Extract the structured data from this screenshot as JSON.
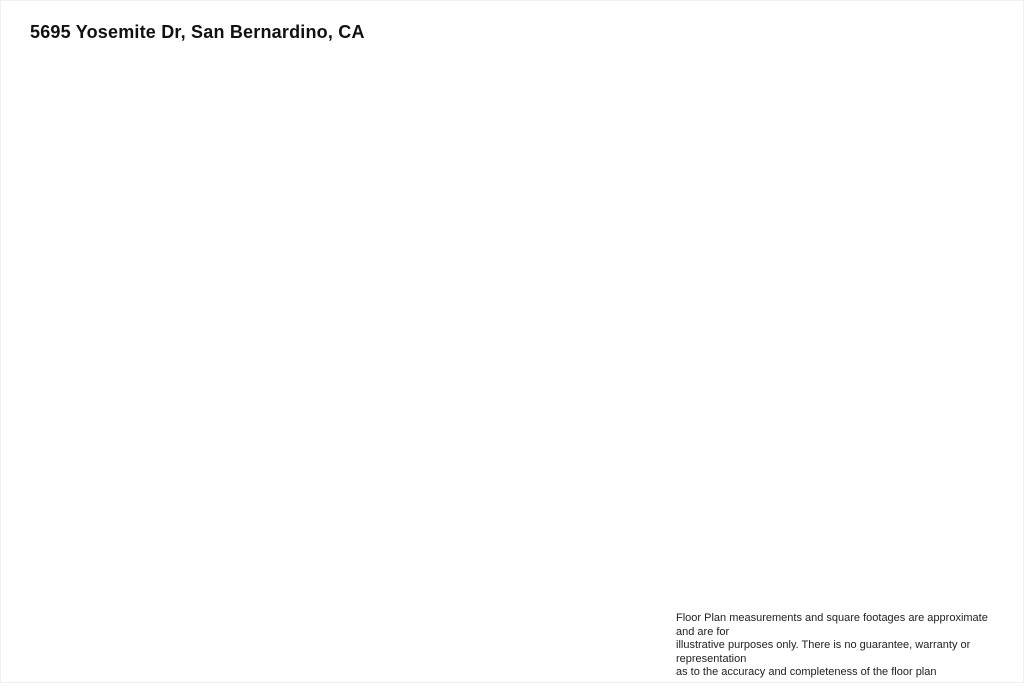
{
  "title": "5695 Yosemite Dr, San Bernardino, CA",
  "rooms": [
    {
      "name": "KITCHEN",
      "dims": "12'7\" x 11'3\""
    },
    {
      "name": "DINING AREA",
      "dims": "8'1\" x 11'3\""
    },
    {
      "name": "BEDROOM",
      "dims": "9'11\" x 14'4\""
    },
    {
      "name": "PRIMARY BEDROOM",
      "dims": "15'6\" x 17'2\""
    },
    {
      "name": "BATH",
      "dims": "9'7\" x 5'1\""
    },
    {
      "name": "LIVING ROOM",
      "dims": "22'11\" x 12'10\""
    },
    {
      "name": "HALL",
      "dims": "10'6\" x 5'7\""
    },
    {
      "name": "HALL",
      "dims": "3'6\" x 4'11\""
    },
    {
      "name": "BATH",
      "dims": "9'7\" x 4'11\""
    },
    {
      "name": "OFFICE",
      "dims": "9'10\" x 13'10\""
    },
    {
      "name": "BEDROOM",
      "dims": "13'5\" x 11'7\""
    },
    {
      "name": "FOYER",
      "dims": "6'3\" x 6'3\""
    }
  ],
  "disclaimer": {
    "line1": "Floor Plan measurements and square footages are approximate and are for",
    "line2": "illustrative purposes only. There is no guarantee, warranty or representation",
    "line3": "as to the accuracy and completeness of the floor plan"
  },
  "colors": {
    "wall": "#0a0a0a",
    "fixture": "#555555",
    "text": "#2e2e2e",
    "background": "#ffffff"
  }
}
